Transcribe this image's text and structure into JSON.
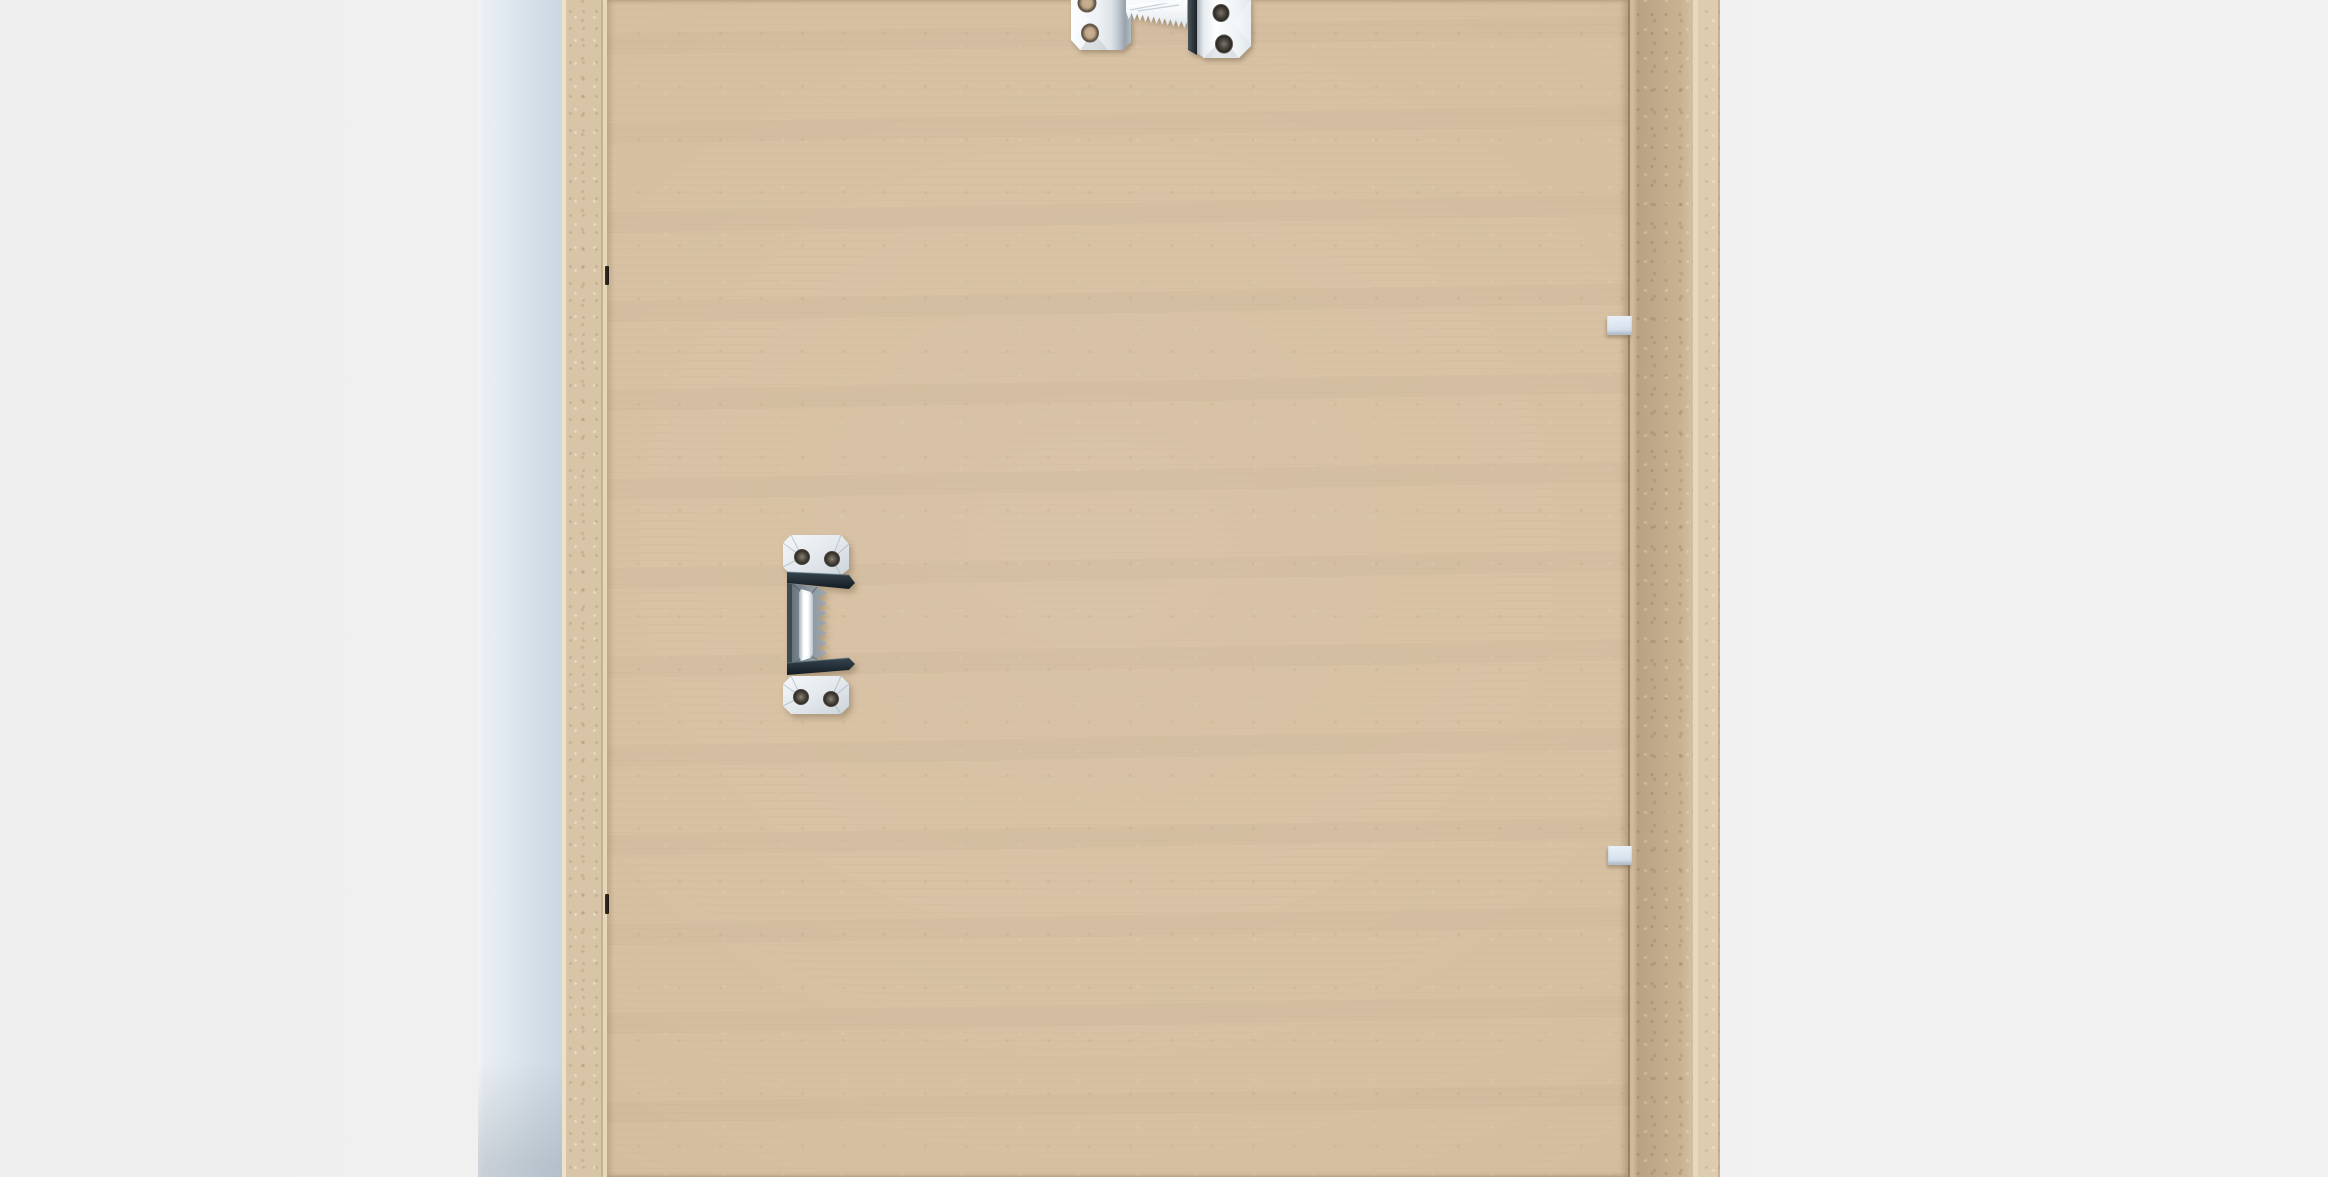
{
  "scene": {
    "description": "Back view of a picture frame: kraft MDF backing board held in a white-painted frame, with sawtooth hanging hardware and flexi-point clips",
    "subject": "picture-frame-back",
    "text_content": "none"
  },
  "colors": {
    "bg-left": "#efeff0",
    "bg-right": "#f2f2f3",
    "face-light": "#f3f5f8",
    "face-mid": "#dde6ee",
    "face-dark": "#ccd7e2",
    "mdf-edge": "#d8c4a6",
    "mdf-line": "#eee1c5",
    "panel": "#d7c0a2",
    "wall": "#c3ac8d",
    "wall-dark": "#b59e7f",
    "wall-line": "#e8d9bc",
    "outer-strip": "#ddccb0",
    "clip-light": "#eaf1f9",
    "clip": "#dbe5f0",
    "clip-dark": "#c7d2df",
    "tab-dark": "#1e1812",
    "metal-bright": "#fbfdfe",
    "metal-mid": "#dfe5ea",
    "metal-shade": "#8d979f",
    "slot-dark": "#1c2228"
  },
  "layout": {
    "frame-left-face": {
      "left": 478,
      "top": 0,
      "width": 84,
      "height": 1177
    },
    "frame-left-edge": {
      "left": 562,
      "top": 0,
      "width": 45,
      "height": 1177
    },
    "backing-board": {
      "left": 607,
      "top": 0,
      "width": 1021,
      "height": 1177
    },
    "frame-right-inner-wall": {
      "left": 1628,
      "top": 0,
      "width": 65,
      "height": 1177
    },
    "frame-right-edge-line": {
      "left": 1693,
      "top": 0,
      "width": 5,
      "height": 1177
    },
    "frame-right-outer-edge": {
      "left": 1698,
      "top": 0,
      "width": 22,
      "height": 1177
    },
    "sawtooth-hanger-top": {
      "left": 1063,
      "top": 0,
      "width": 192,
      "height": 62
    },
    "sawtooth-hanger-side": {
      "left": 779,
      "top": 531,
      "width": 80,
      "height": 188
    },
    "flexi-clip-top": {
      "left": 1607,
      "top": 316,
      "width": 25,
      "height": 19
    },
    "flexi-clip-bottom": {
      "left": 1608,
      "top": 846,
      "width": 24,
      "height": 19
    },
    "point-tab-top": {
      "left": 605,
      "top": 266,
      "width": 4,
      "height": 19
    },
    "point-tab-bottom": {
      "left": 605,
      "top": 894,
      "width": 4,
      "height": 20
    }
  },
  "hardware": [
    {
      "name": "sawtooth-hanger-top",
      "kind": "sawtooth hanger, horizontal, partially cropped at top edge",
      "holes": 4
    },
    {
      "name": "sawtooth-hanger-side",
      "kind": "sawtooth hanger, mounted vertically, teeth facing right",
      "holes": 4
    },
    {
      "name": "flexi-clip-top",
      "kind": "white flexi point clip on right seam"
    },
    {
      "name": "flexi-clip-bottom",
      "kind": "white flexi point clip on right seam"
    },
    {
      "name": "point-tab-top",
      "kind": "dark framer's point on left seam"
    },
    {
      "name": "point-tab-bottom",
      "kind": "dark framer's point on left seam"
    }
  ]
}
